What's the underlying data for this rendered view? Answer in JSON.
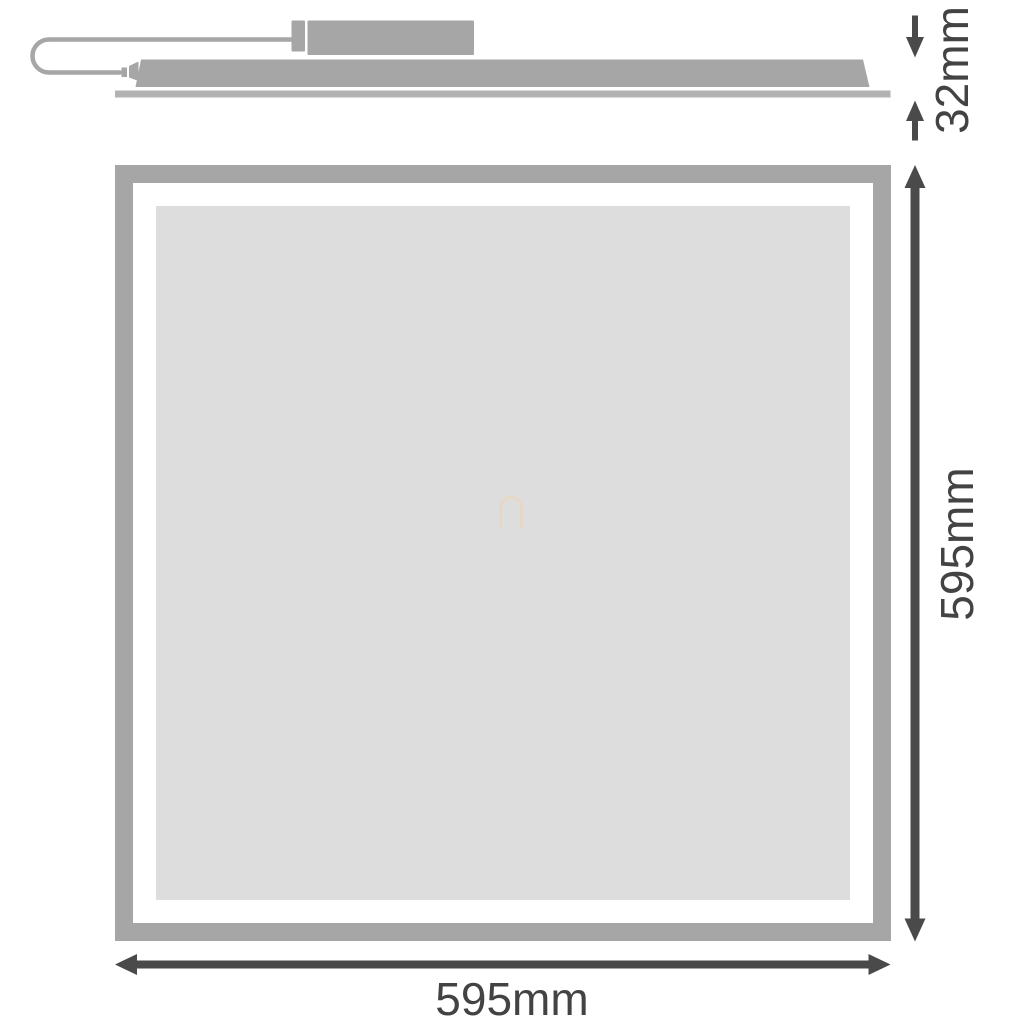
{
  "labels": {
    "thickness": "32mm",
    "height": "595mm",
    "width": "595mm"
  },
  "colors": {
    "background": "#ffffff",
    "shape": "#a6a6a6",
    "flange": "#b2b2b2",
    "panel_fill": "#dcdddc",
    "gap_white": "#ffffff",
    "dimension": "#4a4a4a",
    "text": "#434343",
    "watermark": "#ead7c1"
  }
}
